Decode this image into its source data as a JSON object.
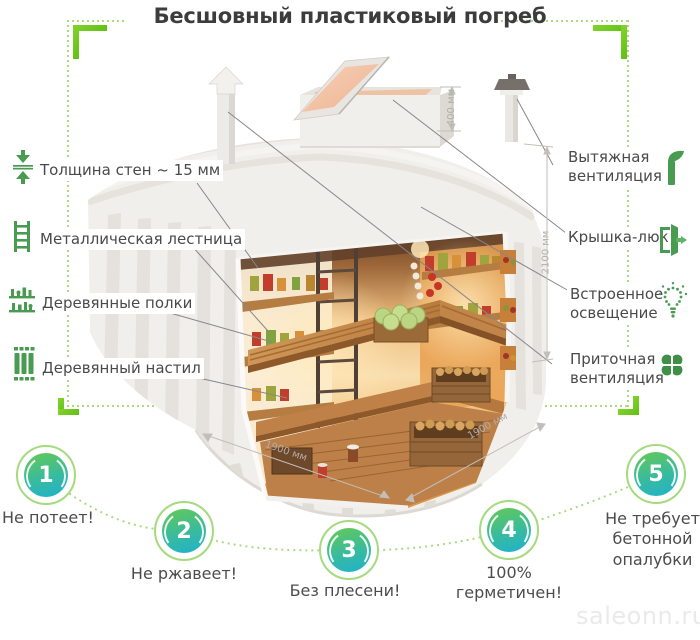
{
  "title": "Бесшовный пластиковый погреб",
  "watermark": "saleonn.ru",
  "left_labels": [
    {
      "label": "Толщина стен ~ 15 мм",
      "icon": "wall-thickness-icon"
    },
    {
      "label": "Металлическая лестница",
      "icon": "ladder-icon"
    },
    {
      "label": "Деревянные полки",
      "icon": "shelves-icon"
    },
    {
      "label": "Деревянный настил",
      "icon": "decking-icon"
    }
  ],
  "right_labels": [
    {
      "label": "Вытяжная вентиляция",
      "icon": "exhaust-vent-icon"
    },
    {
      "label": "Крышка-люк",
      "icon": "hatch-door-icon"
    },
    {
      "label": "Встроенное освещение",
      "icon": "light-bulb-icon"
    },
    {
      "label": "Приточная вентиляция",
      "icon": "fan-icon"
    }
  ],
  "dimensions": {
    "hatch_height": "400 мм",
    "body_height": "2100 мм",
    "width": "1900 мм",
    "depth": "1900 мм"
  },
  "benefits": [
    {
      "number": "1",
      "label": "Не потеет!"
    },
    {
      "number": "2",
      "label": "Не ржавеет!"
    },
    {
      "number": "3",
      "label": "Без плесени!"
    },
    {
      "number": "4",
      "label": "100% герметичен!"
    },
    {
      "number": "5",
      "label": "Не требует бетонной опалубки"
    }
  ],
  "colors": {
    "accent_green": "#4a9b52",
    "bright_green": "#68c71b",
    "dotted_green": "#aed983",
    "circle_ring": "#a5da7f",
    "circle_gradient_start": "#5fc75f",
    "circle_gradient_end": "#20b1cf",
    "text": "#4a4a4a",
    "dimension_gray": "#b2aeaa"
  }
}
